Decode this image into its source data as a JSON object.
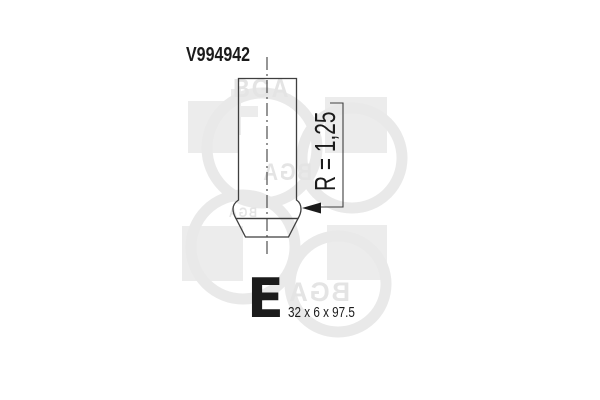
{
  "part": {
    "number": "V994942",
    "radius_dimension": "R = 1,25",
    "type_letter": "E",
    "size_spec": "32 x 6 x 97.5"
  },
  "watermark": {
    "brand": "BGA",
    "square_color": "#ececec",
    "ring_color": "#e9e9e9",
    "text_color": "#e4e4e4"
  },
  "drawing": {
    "line_color": "#3f3f3f",
    "text_color": "#1b1b1b",
    "background": "#ffffff"
  }
}
